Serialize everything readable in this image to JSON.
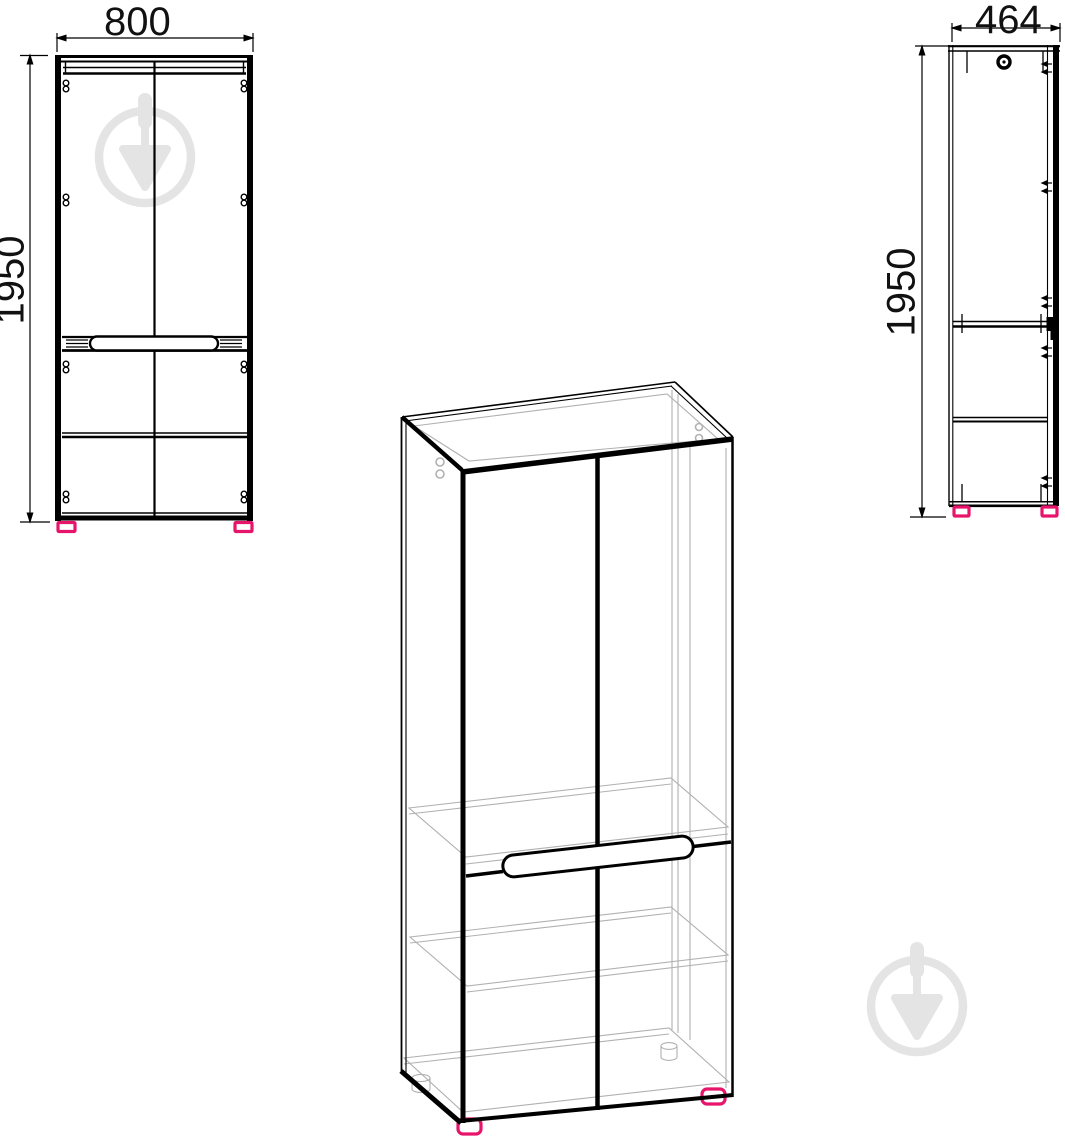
{
  "drawing": {
    "type": "furniture-dimension-drawing",
    "views": {
      "front": {
        "name": "front-view",
        "width_label": "800",
        "height_label": "1950"
      },
      "side": {
        "name": "side-view",
        "width_label": "464",
        "height_label": "1950"
      },
      "perspective": {
        "name": "perspective-view"
      }
    },
    "icons": {
      "watermark": "trowel-in-circle-watermark-icon",
      "hardware": [
        "hinge-screw-icon",
        "cam-lock-icon"
      ]
    },
    "colors": {
      "line": "#000000",
      "interior_line": "#b1b1b1",
      "feet_accent": "#e6156b",
      "watermark": "#e4e4e4",
      "background": "#ffffff",
      "label_text": "#111111"
    }
  }
}
